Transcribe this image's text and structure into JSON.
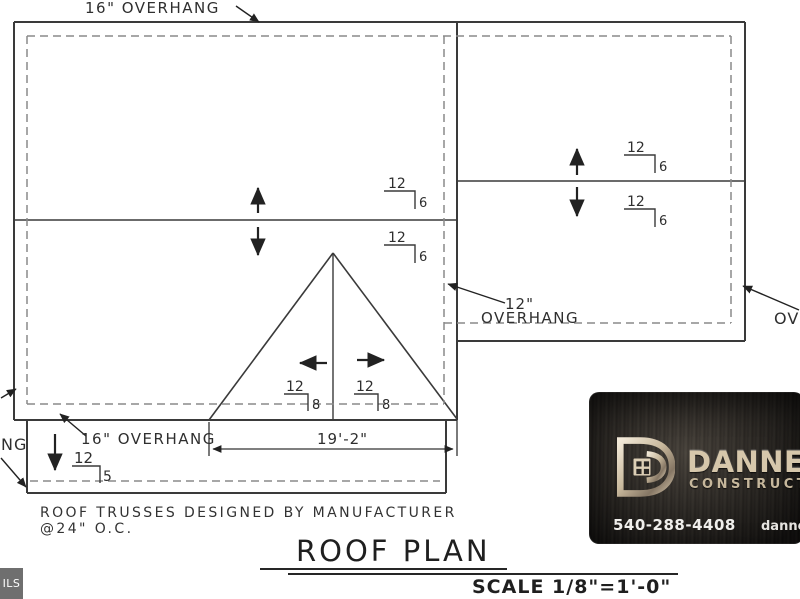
{
  "plan": {
    "top_overhang_label": "16\" OVERHANG",
    "bottom_overhang_label": "16\" OVERHANG",
    "side_overhang_size": "12\"",
    "side_overhang_word": "OVERHANG",
    "left_edge_partial_label": "NG",
    "right_edge_partial_label": "OV",
    "gable_dimension": "19'-2\"",
    "slopes": [
      {
        "id": "main-upper",
        "run": "12",
        "rise": "6"
      },
      {
        "id": "main-lower",
        "run": "12",
        "rise": "6"
      },
      {
        "id": "wing-upper",
        "run": "12",
        "rise": "6"
      },
      {
        "id": "wing-lower",
        "run": "12",
        "rise": "6"
      },
      {
        "id": "gable-left",
        "run": "12",
        "rise": "8"
      },
      {
        "id": "gable-right",
        "run": "12",
        "rise": "8"
      },
      {
        "id": "porch",
        "run": "12",
        "rise": "5"
      }
    ]
  },
  "notes": {
    "line1": "ROOF TRUSSES DESIGNED BY MANUFACTURER",
    "line2": "@24\" O.C."
  },
  "title_block": {
    "title": "ROOF PLAN",
    "scale": "SCALE 1/8\"=1'-0\""
  },
  "logo_card": {
    "brand_partial": "DANNE",
    "brand_sub_partial": "CONSTRUCT",
    "phone": "540-288-4408",
    "website_partial": "danne"
  },
  "corner_tab": {
    "label_partial": "ILS"
  },
  "colors": {
    "wall_line": "#3a3a3a",
    "overhang_dash": "#8a8a8a",
    "annotation": "#222222",
    "card_metal": "#d6c7ab",
    "card_bg": "#2b2825",
    "tab_bg": "#6f6f6f"
  }
}
